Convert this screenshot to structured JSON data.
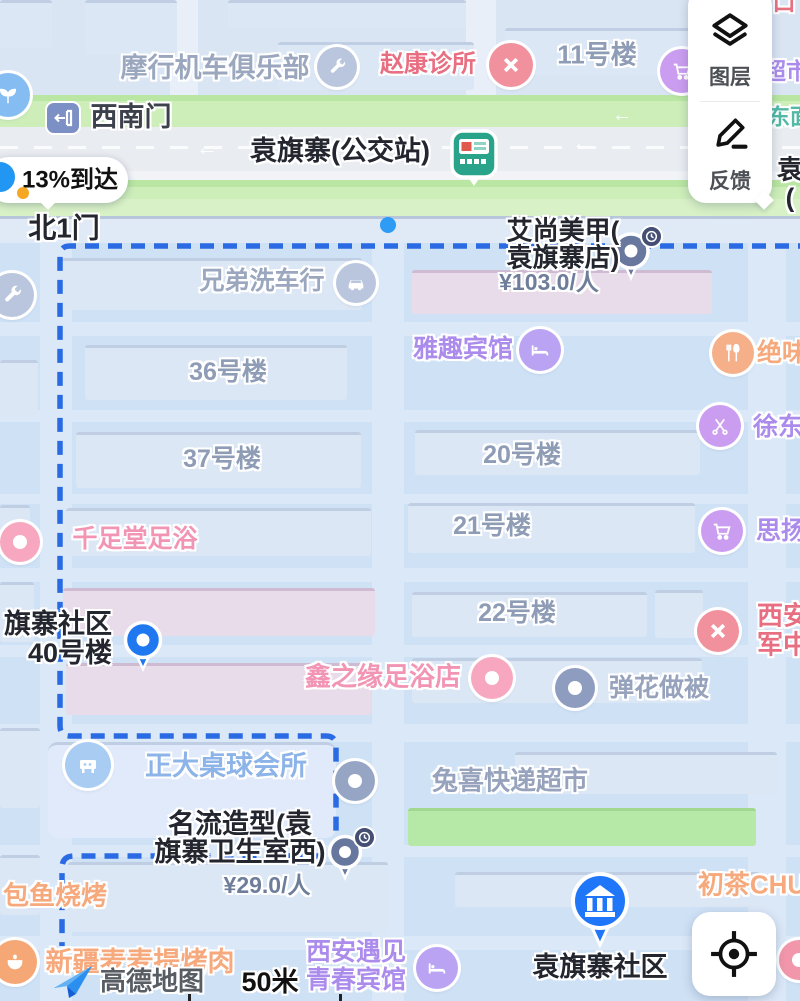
{
  "app": "高德地图",
  "panel": {
    "layers_label": "图层",
    "feedback_label": "反馈"
  },
  "status": {
    "arrival_text": "13%到达"
  },
  "roads": {
    "west_gate": "西南门",
    "north_gate": "北1门",
    "bus_station": "袁旗寨(公交站)",
    "east_road_partial": "东面",
    "edge_label_line1": "袁",
    "edge_label_line2": "("
  },
  "buildings": {
    "b11": "11号楼",
    "b36": "36号楼",
    "b37": "37号楼",
    "b20": "20号楼",
    "b21": "21号楼",
    "b22": "22号楼"
  },
  "pois": {
    "moto_club": "摩行机车俱乐部",
    "clinic": "赵康诊所",
    "supermarket_partial": "超市",
    "corner_red_partial": "口",
    "nail_salon_line1": "艾尚美甲(",
    "nail_salon_line2": "袁旗寨店)",
    "nail_salon_price": "¥103.0/人",
    "car_wash": "兄弟洗车行",
    "yaqu_hotel": "雅趣宾馆",
    "juewei_partial": "绝味",
    "xudong_partial": "徐东",
    "qianzutang": "千足堂足浴",
    "siyang_partial": "思扬",
    "community40_line1": "旗寨社区",
    "community40_line2": "40号楼",
    "military_line1": "西安",
    "military_line2": "军中",
    "xinzhiyuan": "鑫之缘足浴店",
    "tanhua": "弹花做被",
    "billiards": "正大桌球会所",
    "tuxi": "兔喜快递超市",
    "mingliu_line1": "名流造型(袁",
    "mingliu_line2": "旗寨卫生室西)",
    "mingliu_price": "¥29.0/人",
    "baoyu": "包鱼烧烤",
    "chucha_partial": "初茶CHU",
    "xinjiang": "新疆麦麦提烤肉",
    "yujian_line1": "西安遇见",
    "yujian_line2": "青春宾馆",
    "community_main": "袁旗寨社区"
  },
  "footer": {
    "brand": "高德地图",
    "scale": "50米"
  },
  "colors": {
    "route_blue": "#2a6be4",
    "pin_blue": "#1f78f0",
    "pin_gray": "#6e80a8",
    "road_green": "#cdeeb9",
    "poi_pink": "#f7a8c0",
    "poi_purple": "#cb9df0",
    "poi_orange": "#f5b089",
    "poi_red": "#f2919e",
    "poi_grayblue": "#b9c6dd",
    "bus_green": "#2aa38b",
    "building_green": "#b6e8a7"
  }
}
